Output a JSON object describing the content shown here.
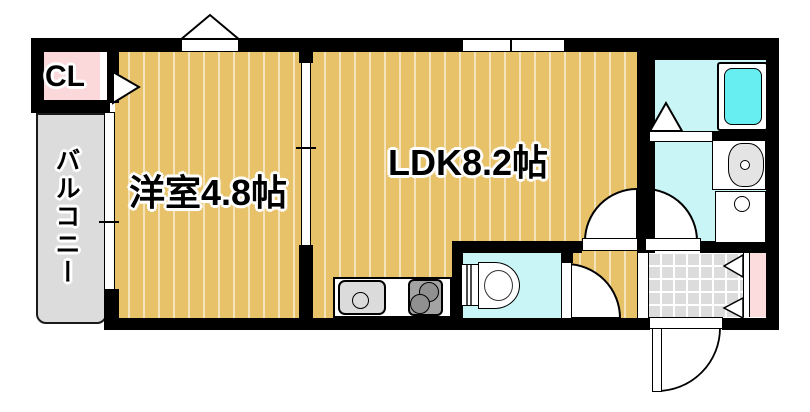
{
  "page": {
    "type": "japanese-apartment-floor-plan",
    "background": "#ffffff"
  },
  "labels": {
    "closet": "CL",
    "balcony": "バルコニー",
    "western_room": "洋室4.8帖",
    "ldk": "LDK8.2帖"
  },
  "colors": {
    "wall": "#000000",
    "wood_floor": "#e7c269",
    "wet_area_cyan": "#c9f5f7",
    "bathtub_cyan": "#66eef1",
    "closet_pink": "#fbd9db",
    "shoe_cabinet_pink": "#fcdcdc",
    "balcony_gray": "#dcdcdc",
    "entrance_tile_gray": "#dcdcdc",
    "stove_gray": "#a3a3a3",
    "sink_gray": "#dbdbdb"
  },
  "fixtures": [
    "bathtub",
    "washbasin",
    "washing-machine-pan",
    "toilet",
    "kitchen-sink",
    "gas-stove",
    "entrance-door",
    "shoe-cabinet",
    "closet-door",
    "bath-folding-door",
    "sliding-door",
    "windows",
    "balcony"
  ]
}
